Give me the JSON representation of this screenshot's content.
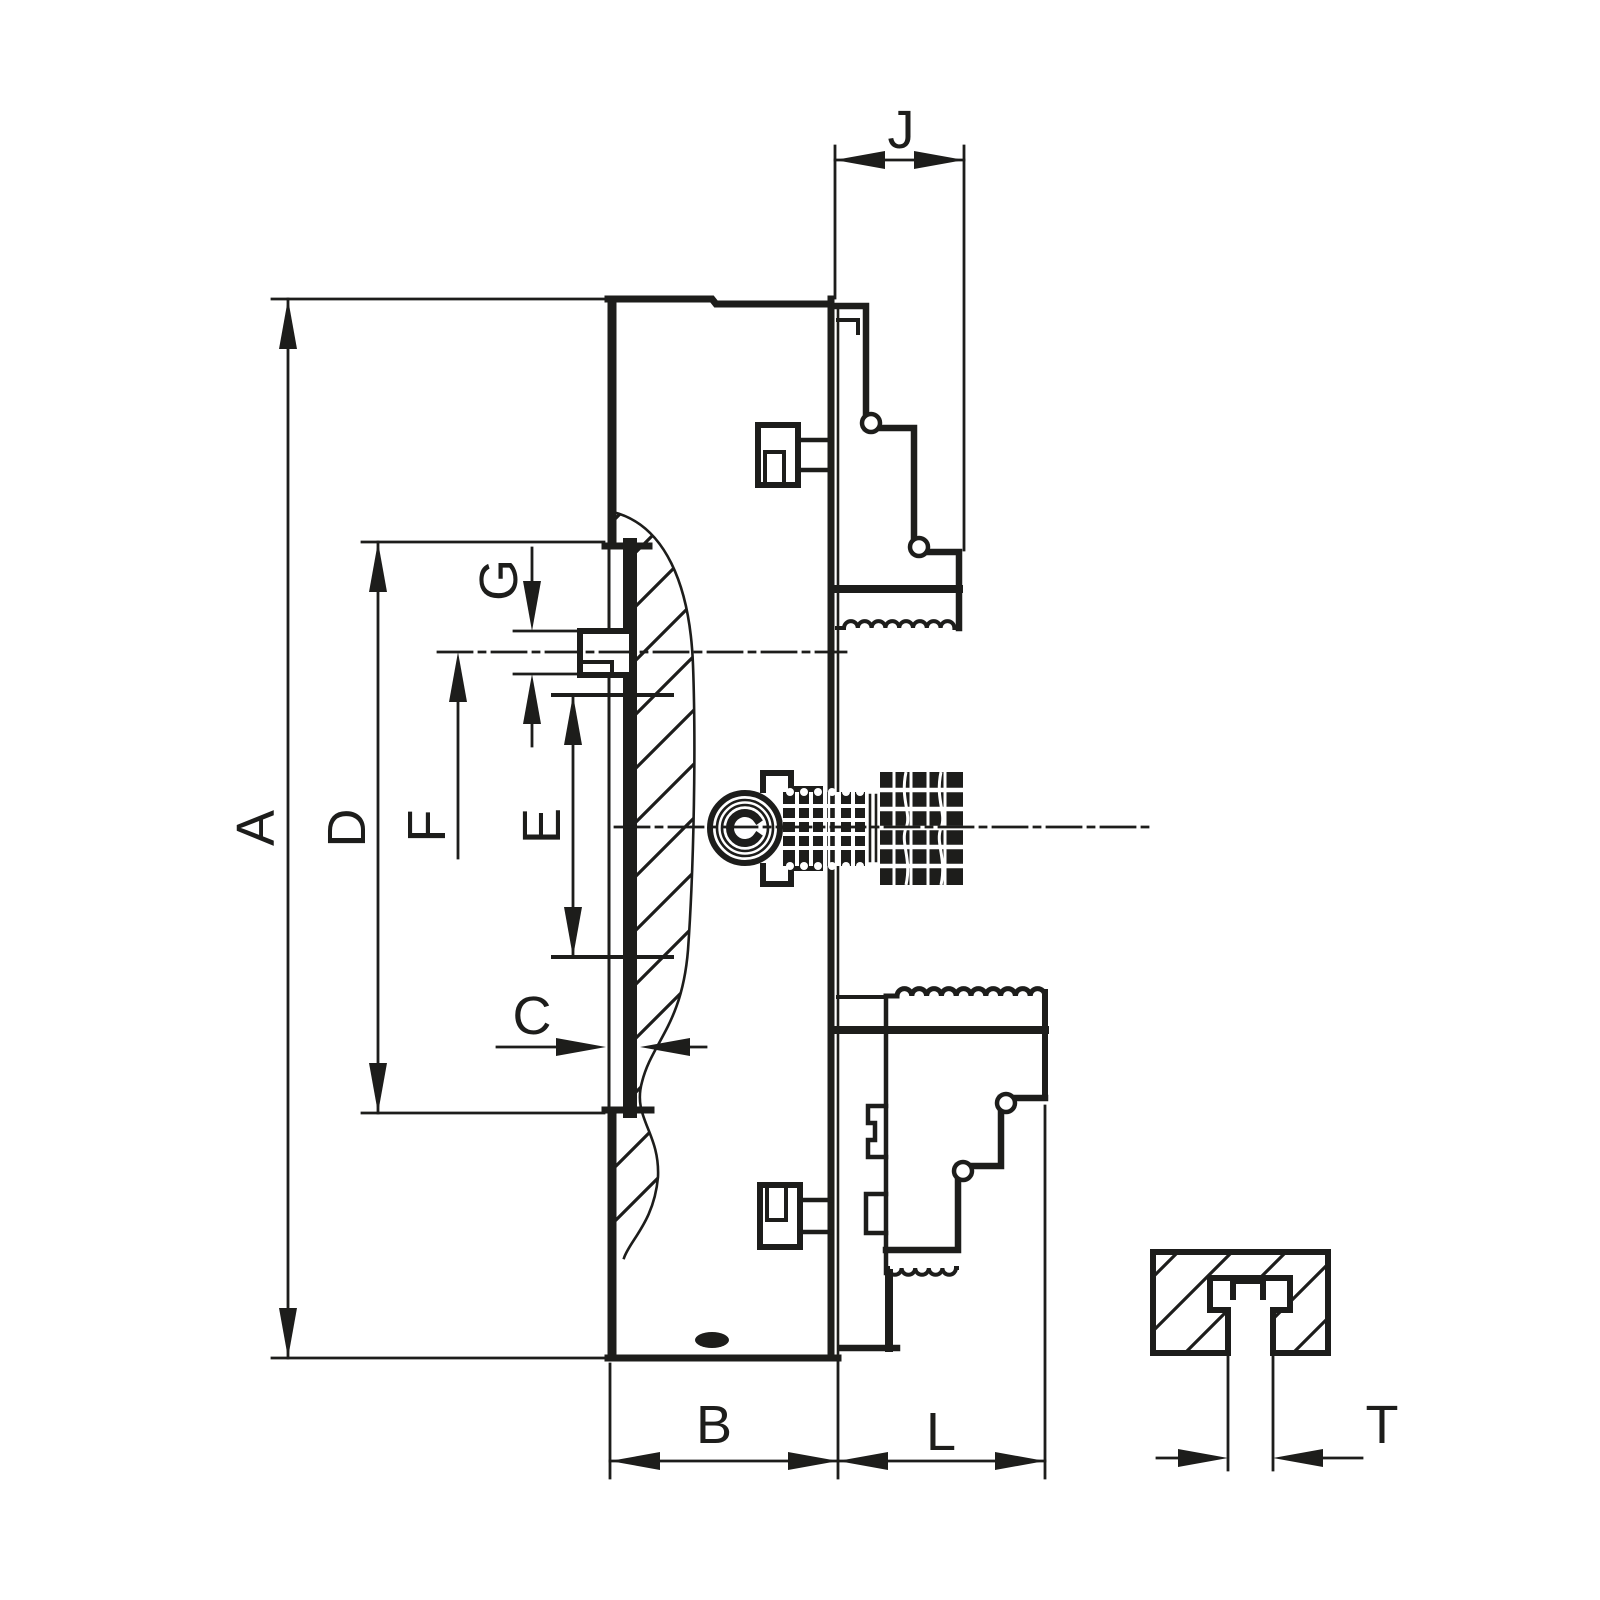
{
  "drawing": {
    "background": "#ffffff",
    "ink": "#1d1d1b",
    "view": "side cross-section of a lathe chuck with T-slot detail view"
  },
  "dimensions": {
    "A": {
      "label": "A"
    },
    "B": {
      "label": "B"
    },
    "C": {
      "label": "C"
    },
    "D": {
      "label": "D"
    },
    "E": {
      "label": "E"
    },
    "F": {
      "label": "F"
    },
    "G": {
      "label": "G"
    },
    "J": {
      "label": "J"
    },
    "L": {
      "label": "L"
    },
    "T": {
      "label": "T"
    }
  }
}
